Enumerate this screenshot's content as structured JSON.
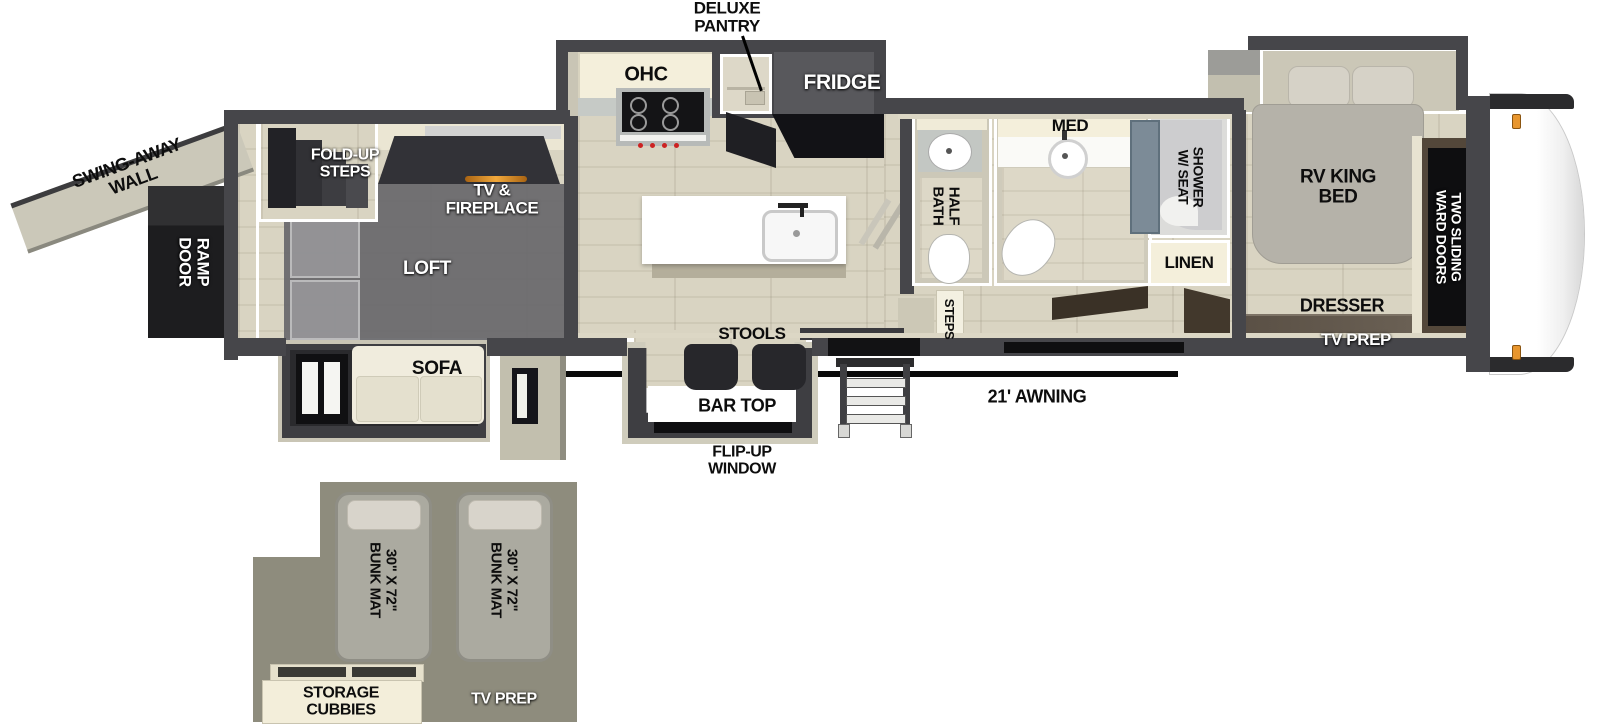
{
  "colors": {
    "wall": "#46464a",
    "floor": "#d8d3c1",
    "cream_cabinet": "#f3eeda",
    "loft_overlay": "#6d6d71",
    "loft_plan_floor": "#8e8c7d",
    "flame_accent": "#e8962e",
    "marker_light": "#e8962e",
    "shower_glass": "#7c8b97",
    "label_black": "#0d0d0d",
    "label_white": "#ffffff"
  },
  "main_floorplan": {
    "exterior": {
      "swing_away_wall": "SWING-AWAY\nWALL",
      "ramp_door": "RAMP\nDOOR",
      "awning": "21' AWNING",
      "flip_up_window": "FLIP-UP\nWINDOW"
    },
    "garage": {
      "fold_up_steps": "FOLD-UP\nSTEPS",
      "tv_fireplace": "TV &\nFIREPLACE",
      "loft": "LOFT",
      "sofa": "SOFA"
    },
    "kitchen": {
      "deluxe_pantry": "DELUXE\nPANTRY",
      "ohc": "OHC",
      "fridge": "FRIDGE",
      "stools": "STOOLS",
      "bar_top": "BAR TOP"
    },
    "bath": {
      "half_bath": "HALF\nBATH",
      "med": "MED",
      "steps": "STEPS",
      "shower": "SHOWER\nW/ SEAT",
      "linen": "LINEN"
    },
    "bedroom": {
      "rv_king_bed": "RV KING\nBED",
      "ward_doors": "TWO SLIDING\nWARD DOORS",
      "dresser": "DRESSER",
      "tv_prep": "TV PREP"
    }
  },
  "loft_plan": {
    "bunk_mats": [
      "30\" X 72\"\nBUNK MAT",
      "30\" X 72\"\nBUNK MAT"
    ],
    "storage_cubbies": "STORAGE\nCUBBIES",
    "tv_prep": "TV PREP"
  }
}
